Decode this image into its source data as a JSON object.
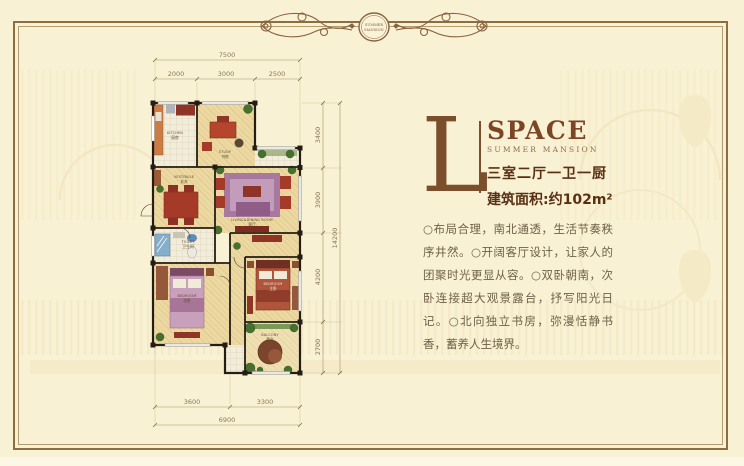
{
  "ornament": {
    "badge_line1": "SUMMER",
    "badge_line2": "MANSION"
  },
  "header": {
    "letter": "L",
    "title": "SPACE",
    "subtitle": "SUMMER MANSION",
    "rooms_line": "三室二厅一卫一厨",
    "area_line": "建筑面积:约102m²"
  },
  "description": "○布局合理，南北通透，生活节奏秩序井然。○开阔客厅设计，让家人的团聚时光更显从容。○双卧朝南，次卧连接超大观景露台，抒写阳光日记。○北向独立书房，弥漫恬静书香，蓄养人生境界。",
  "floorplan": {
    "rooms": [
      {
        "label": "KITCHEN",
        "cn": "厨房"
      },
      {
        "label": "STUDY",
        "cn": "书房"
      },
      {
        "label": "VESTIBULE",
        "cn": "玄关"
      },
      {
        "label": "LIVING&DINING ROOM",
        "cn": "客厅"
      },
      {
        "label": "TOILET",
        "cn": "卫生间"
      },
      {
        "label": "BEDROOM",
        "cn": "次卧"
      },
      {
        "label": "BEDROOM",
        "cn": "主卧"
      },
      {
        "label": "BALCONY",
        "cn": "露台"
      }
    ],
    "dimensions": {
      "top_total": "7500",
      "top_segments": [
        "2000",
        "3000",
        "2500"
      ],
      "right_total": "14200",
      "right_segments": [
        "3400",
        "3900",
        "4200",
        "2700"
      ],
      "bottom_total": "6900",
      "bottom_segments": [
        "3600",
        "3300"
      ]
    }
  },
  "colors": {
    "background": "#f9f1d4",
    "frame": "#8b6f42",
    "accent_brown": "#7b4526",
    "text_dark": "#5a3014",
    "body_text": "#6f604a",
    "wall": "#241d16"
  }
}
